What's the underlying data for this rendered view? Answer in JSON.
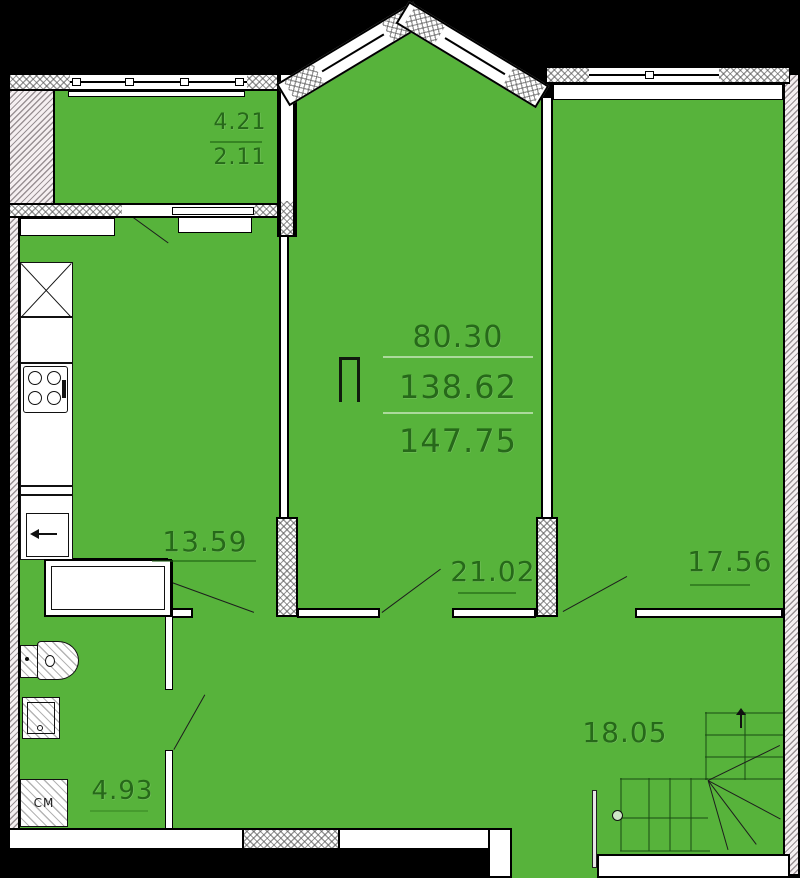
{
  "plan": {
    "background": "#000000",
    "room_fill": "#57b33b",
    "labels": {
      "balcony_area": "4.21",
      "balcony_area_coeff": "2.11",
      "kitchen_area": "13.59",
      "living_area": "21.02",
      "bedroom_area": "17.56",
      "hall_area": "18.05",
      "bathroom_area": "4.93",
      "washing_machine": "СМ"
    },
    "summary": {
      "symbol": "П",
      "line1": "80.30",
      "line2": "138.62",
      "line3": "147.75"
    }
  }
}
